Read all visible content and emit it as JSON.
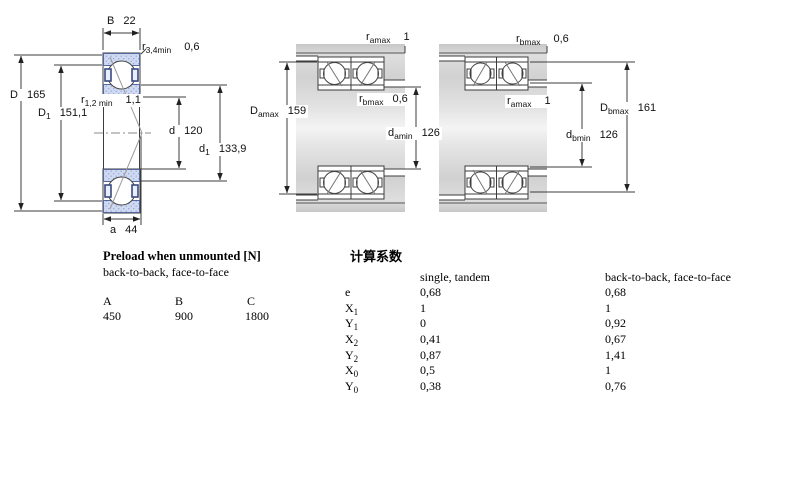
{
  "drawing": {
    "left": {
      "B": {
        "base": "B",
        "value": "22"
      },
      "r34": {
        "base": "r",
        "sub": "3,4min",
        "value": "0,6"
      },
      "D": {
        "base": "D",
        "value": "165"
      },
      "r12": {
        "base": "r",
        "sub": "1,2 min",
        "value": "1,1"
      },
      "D1": {
        "base": "D",
        "sub": "1",
        "value": "151,1"
      },
      "d": {
        "base": "d",
        "value": "120"
      },
      "d1": {
        "base": "d",
        "sub": "1",
        "value": "133,9"
      },
      "a": {
        "base": "a",
        "value": "44"
      }
    },
    "middle": {
      "ramax": {
        "base": "r",
        "sub": "amax",
        "value": "1"
      },
      "Damax": {
        "base": "D",
        "sub": "amax",
        "value": "159"
      },
      "rbmax": {
        "base": "r",
        "sub": "bmax",
        "value": "0,6"
      },
      "damin": {
        "base": "d",
        "sub": "amin",
        "value": "126"
      }
    },
    "right": {
      "rbmax": {
        "base": "r",
        "sub": "bmax",
        "value": "0,6"
      },
      "ramax": {
        "base": "r",
        "sub": "amax",
        "value": "1"
      },
      "Dbmax": {
        "base": "D",
        "sub": "bmax",
        "value": "161"
      },
      "dbmin": {
        "base": "d",
        "sub": "bmin",
        "value": "126"
      }
    }
  },
  "preload_table": {
    "title": "Preload when unmounted [N]",
    "subtitle": "back-to-back, face-to-face",
    "columns": [
      "A",
      "B",
      "C"
    ],
    "values": [
      "450",
      "900",
      "1800"
    ]
  },
  "factors_table": {
    "title": "计算系数",
    "col1_header": "single, tandem",
    "col2_header": "back-to-back, face-to-face",
    "rows": [
      {
        "base": "e",
        "sub": "",
        "v1": "0,68",
        "v2": "0,68"
      },
      {
        "base": "X",
        "sub": "1",
        "v1": "1",
        "v2": "1"
      },
      {
        "base": "Y",
        "sub": "1",
        "v1": "0",
        "v2": "0,92"
      },
      {
        "base": "X",
        "sub": "2",
        "v1": "0,41",
        "v2": "0,67"
      },
      {
        "base": "Y",
        "sub": "2",
        "v1": "0,87",
        "v2": "1,41"
      },
      {
        "base": "X",
        "sub": "0",
        "v1": "0,5",
        "v2": "1"
      },
      {
        "base": "Y",
        "sub": "0",
        "v1": "0,38",
        "v2": "0,76"
      }
    ]
  },
  "colors": {
    "ring_fill": "#cfdaf2",
    "ring_dot": "#93a7d4",
    "cage": "#3a4a80",
    "line": "#3c3c3c",
    "housing_gray": "#d6d6d6"
  }
}
